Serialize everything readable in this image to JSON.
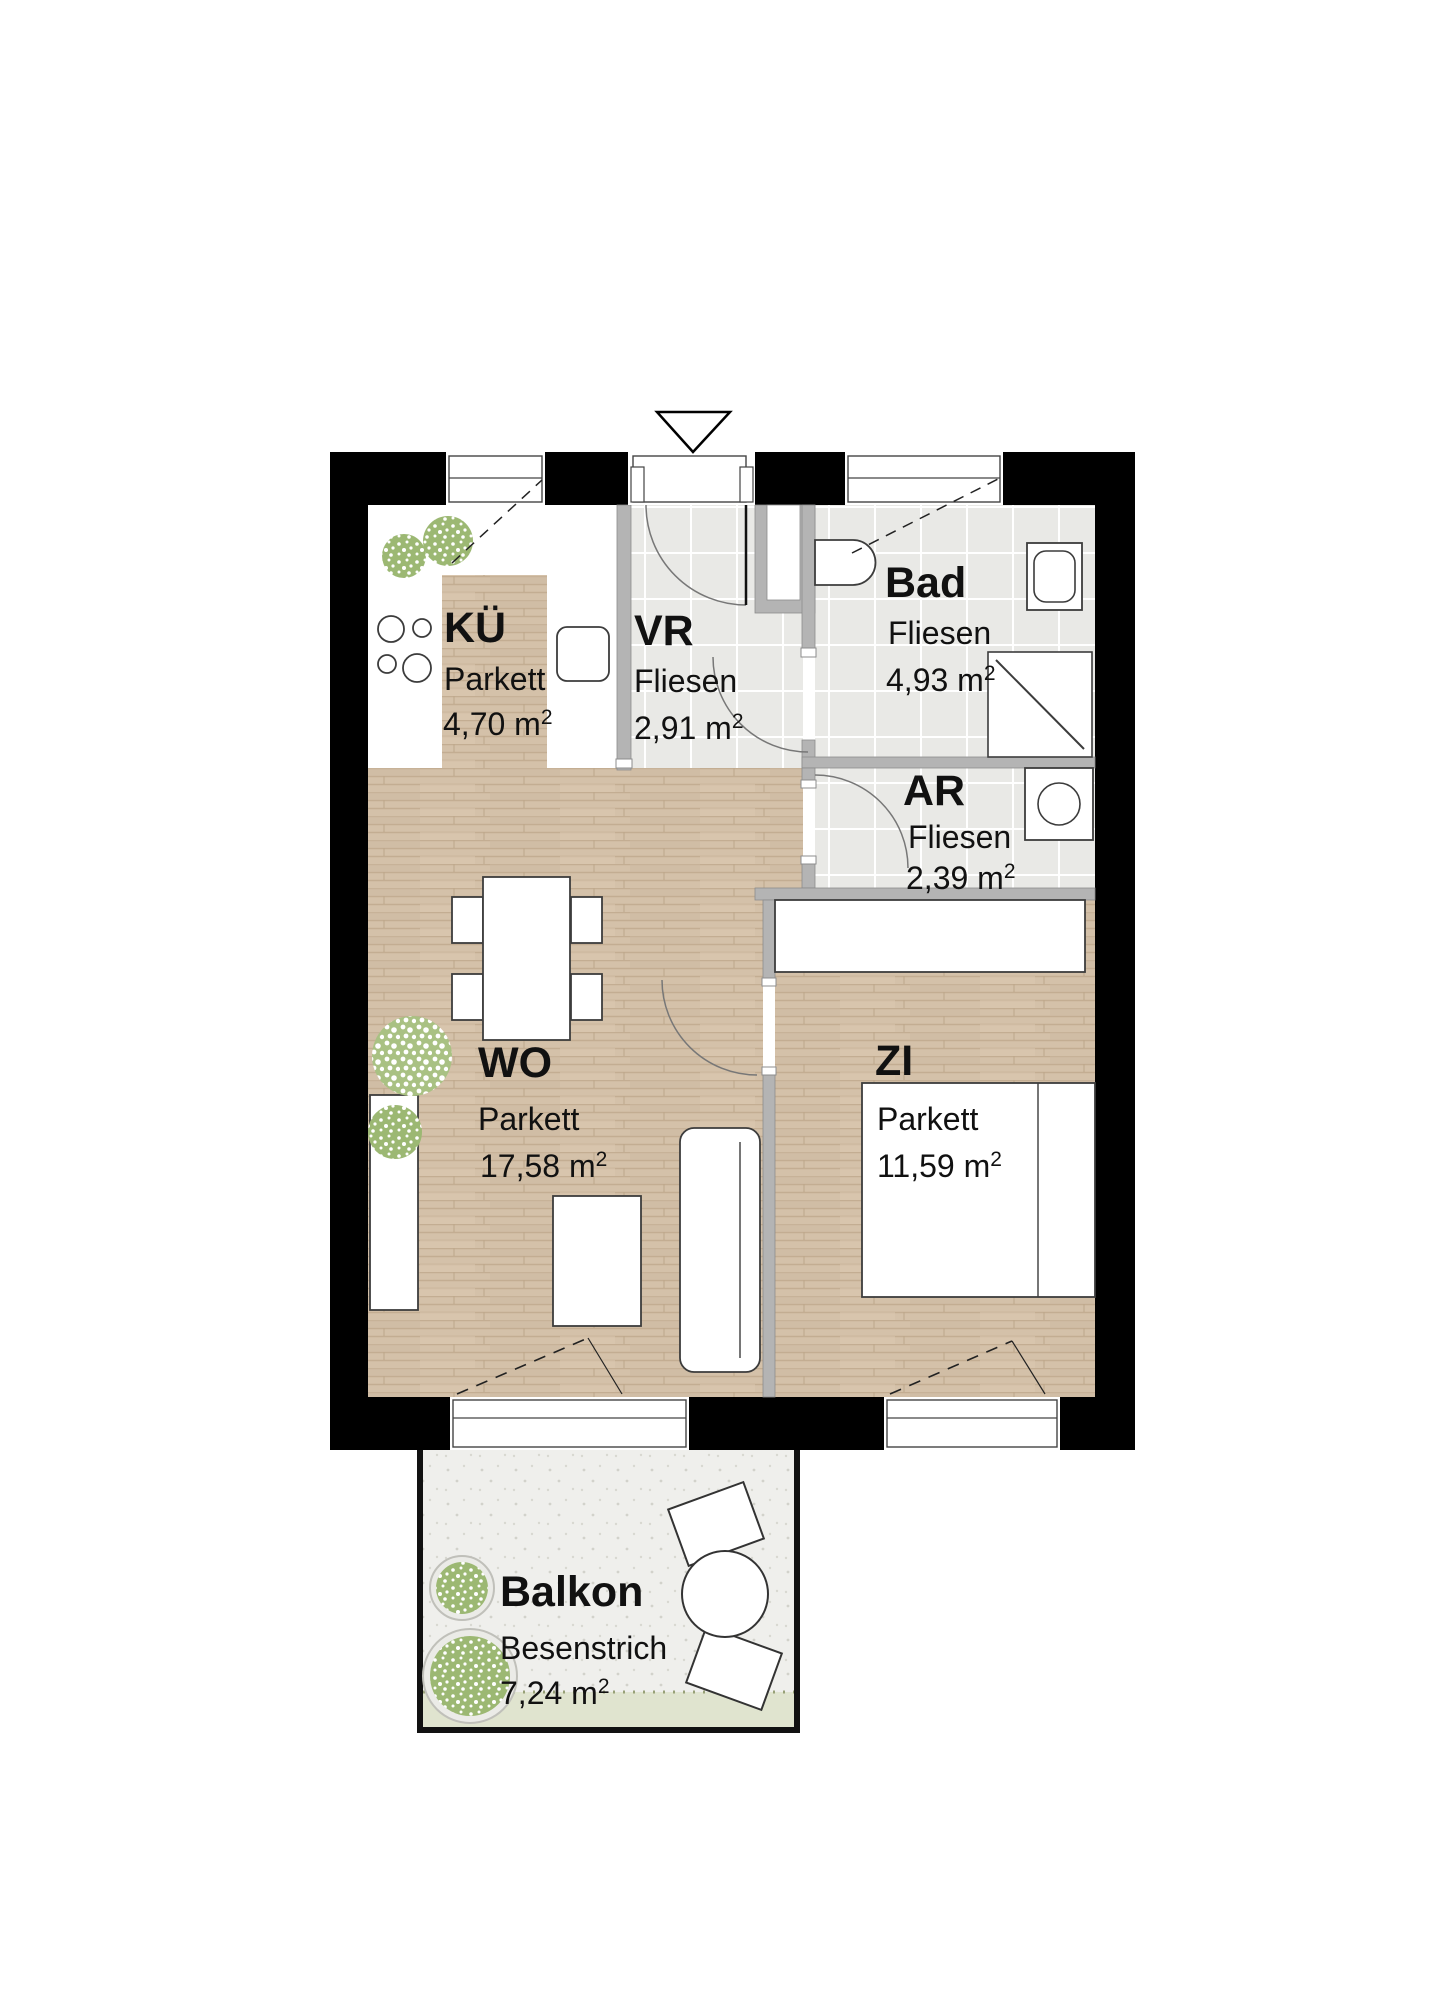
{
  "plan": {
    "title": "floor-plan",
    "rooms": [
      {
        "id": "kue",
        "name": "KÜ",
        "floor": "Parkett",
        "area": "4,70 m",
        "sup": "2"
      },
      {
        "id": "vr",
        "name": "VR",
        "floor": "Fliesen",
        "area": "2,91 m",
        "sup": "2"
      },
      {
        "id": "bad",
        "name": "Bad",
        "floor": "Fliesen",
        "area": "4,93 m",
        "sup": "2"
      },
      {
        "id": "ar",
        "name": "AR",
        "floor": "Fliesen",
        "area": "2,39 m",
        "sup": "2"
      },
      {
        "id": "wo",
        "name": "WO",
        "floor": "Parkett",
        "area": "17,58 m",
        "sup": "2"
      },
      {
        "id": "zi",
        "name": "ZI",
        "floor": "Parkett",
        "area": "11,59 m",
        "sup": "2"
      },
      {
        "id": "balkon",
        "name": "Balkon",
        "floor": "Besenstrich",
        "area": "7,24 m",
        "sup": "2"
      }
    ],
    "icons": [
      "entrance-arrow-icon",
      "cooktop-icon",
      "sink-icon",
      "toilet-icon",
      "washbasin-icon",
      "shower-icon",
      "washing-machine-icon",
      "dining-table",
      "chair",
      "sofa",
      "coffee-table",
      "bed",
      "wardrobe",
      "sideboard",
      "plant-icon",
      "balcony-table",
      "balcony-chair"
    ],
    "colors": {
      "wall_black": "#000000",
      "wall_gray": "#b4b4b4",
      "parquet": "#d4c1a9",
      "parquet_stripe": "#c3ad92",
      "tile": "#e9e9e6",
      "tile_grout": "#ffffff",
      "balcony_floor": "#efefec",
      "balcony_grass": "#e0e4cf",
      "foliage": "#9cb873",
      "furniture_stroke": "#3c3c3c"
    }
  }
}
